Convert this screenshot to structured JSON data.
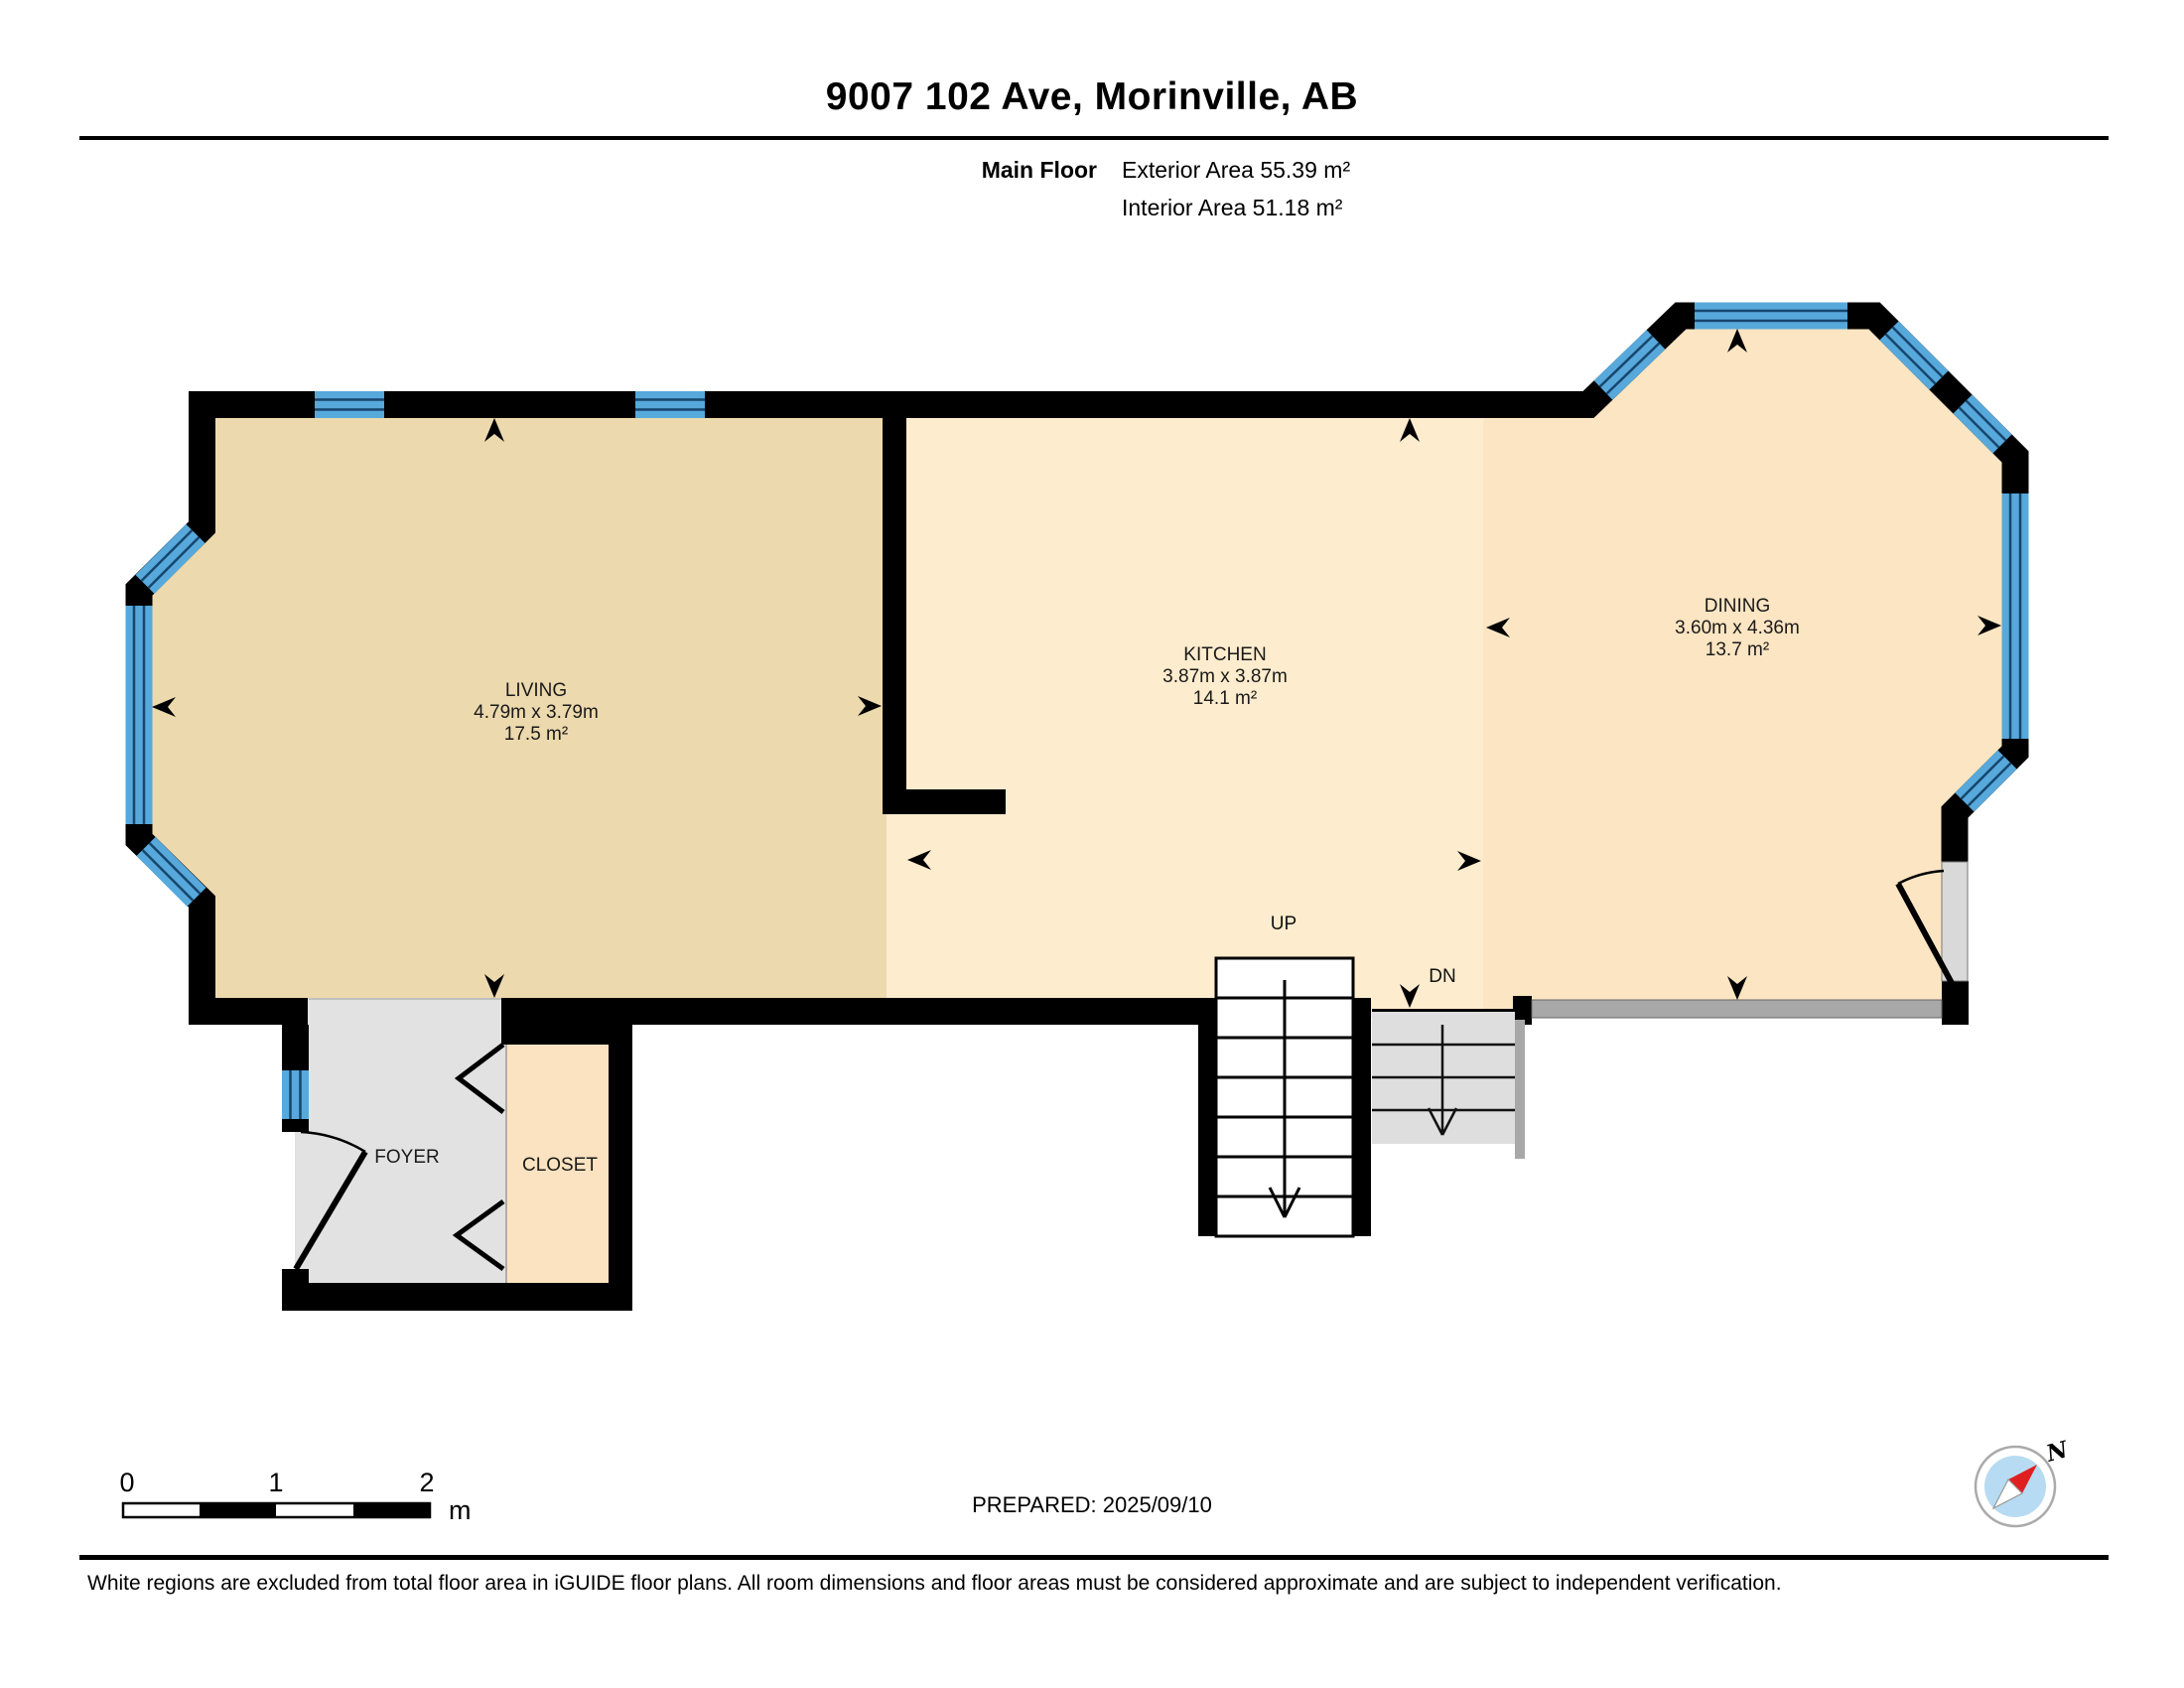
{
  "header": {
    "title": "9007 102 Ave, Morinville, AB",
    "floor_label": "Main Floor",
    "exterior_area": "Exterior Area 55.39 m²",
    "interior_area": "Interior Area 51.18 m²"
  },
  "plan": {
    "rooms": {
      "living": {
        "name": "LIVING",
        "dims": "4.79m x 3.79m",
        "area": "17.5 m²"
      },
      "kitchen": {
        "name": "KITCHEN",
        "dims": "3.87m x 3.87m",
        "area": "14.1 m²"
      },
      "dining": {
        "name": "DINING",
        "dims": "3.60m x 4.36m",
        "area": "13.7 m²"
      },
      "foyer": {
        "name": "FOYER"
      },
      "closet": {
        "name": "CLOSET"
      }
    },
    "stairs": {
      "up": "UP",
      "down": "DN"
    }
  },
  "scale_bar": {
    "ticks": [
      "0",
      "1",
      "2"
    ],
    "unit": "m"
  },
  "compass": {
    "north": "N"
  },
  "footer": {
    "prepared": "PREPARED: 2025/09/10",
    "disclaimer": "White regions are excluded from total floor area in iGUIDE floor plans. All room dimensions and floor areas must be considered approximate and are subject to independent verification."
  },
  "colors": {
    "wall": "#000000",
    "window": "#57a8db",
    "window_line": "#17466d",
    "living": "#ecd9ad",
    "kitchen": "#fdeccd",
    "dining": "#fce5c2",
    "closet": "#fbe3c1",
    "foyer": "#e2e2e2",
    "stair_dn": "#dedede",
    "railing": "#a8a8a8",
    "door_panel": "#d9d9d9",
    "compass_inner": "#b7dbf2",
    "compass_needle": "#e02020"
  }
}
